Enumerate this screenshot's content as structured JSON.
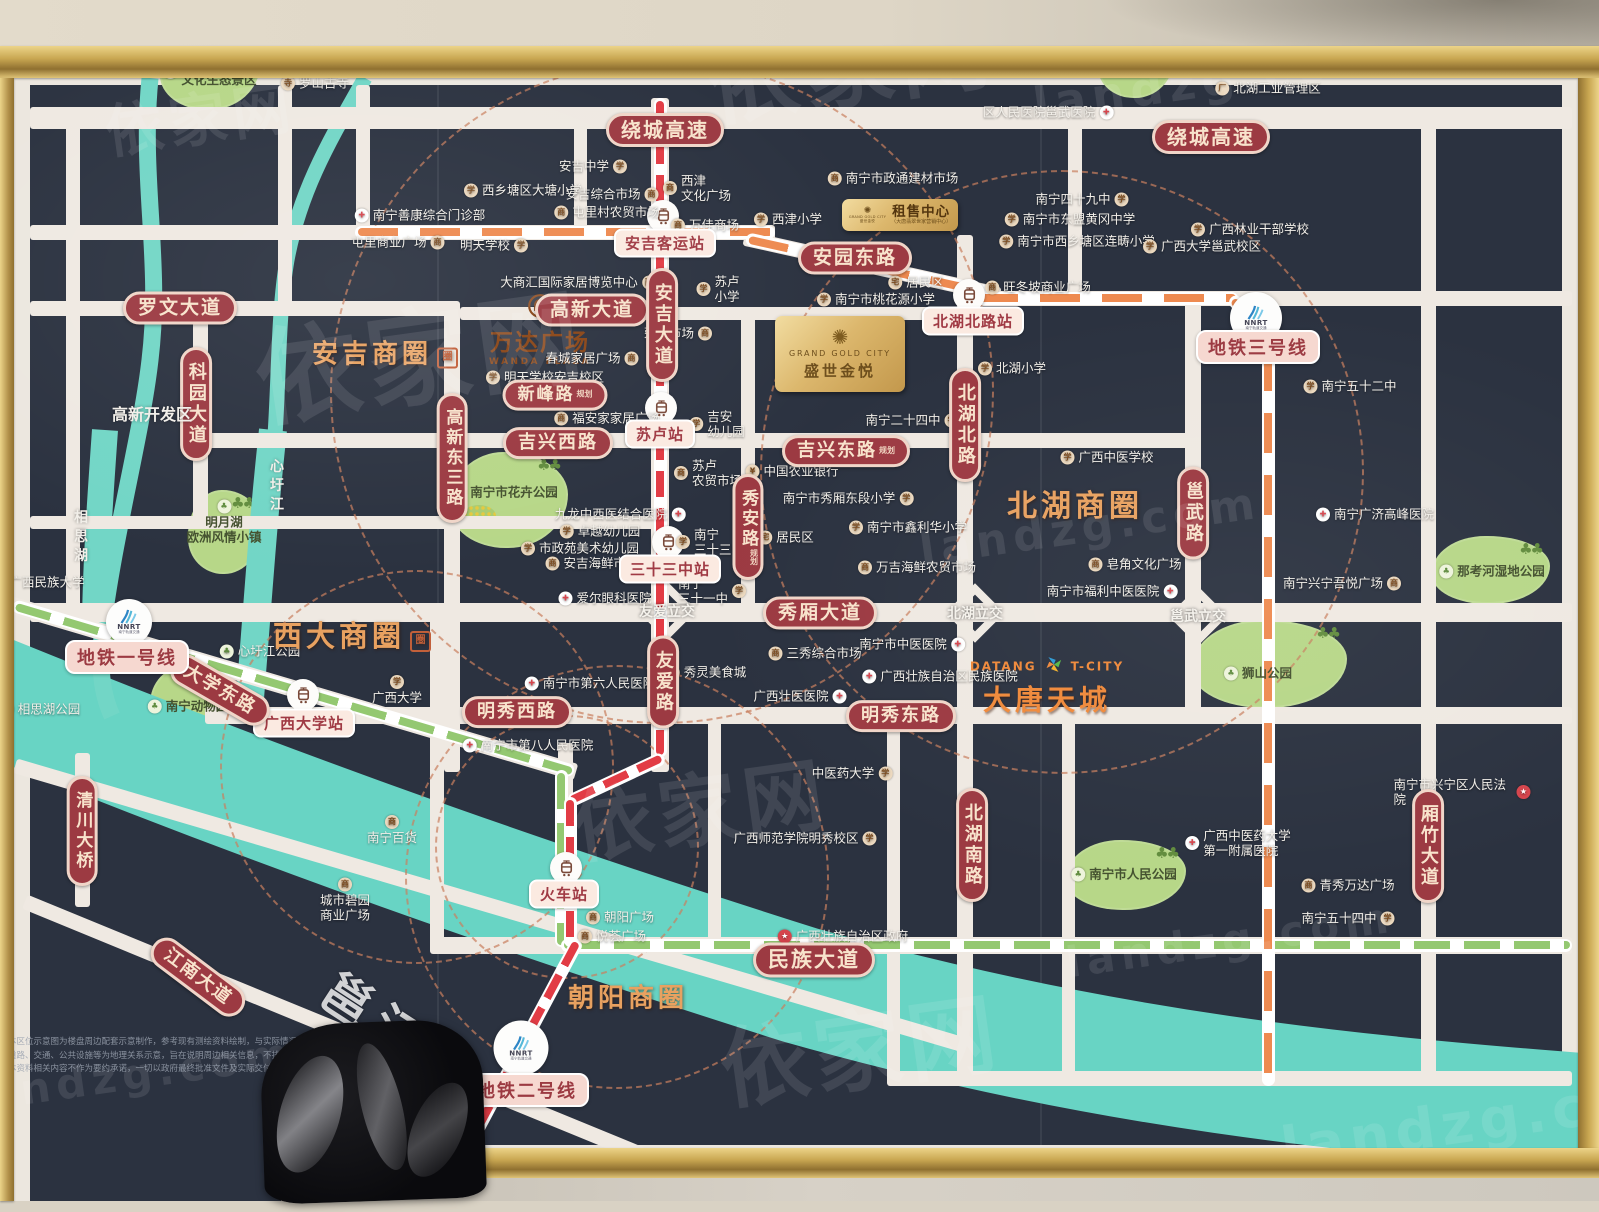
{
  "watermark": {
    "brand": "依家网",
    "url": "landzg.com"
  },
  "plates": {
    "main": {
      "en": "GRAND GOLD CITY",
      "cn": "盛世金悦"
    },
    "rental": {
      "title": "租售中心",
      "sub": "（大唐翡翠世家营销中心）",
      "logo_en": "GRAND GOLD CITY",
      "logo_cn": "盛世金悦"
    }
  },
  "brands": {
    "wanda": {
      "cn": "万达广场",
      "en": "WANDA PLAZA"
    },
    "datang": {
      "left": "DATANG",
      "right": "T-CITY",
      "cn": "大唐天城"
    },
    "nnrt": "NNRT",
    "nnrt_sub": "南宁轨道交通"
  },
  "business_circles": [
    {
      "l": "安吉商圈",
      "x": 385,
      "y": 352,
      "fs": 26,
      "seal": 1
    },
    {
      "l": "西大商圈",
      "x": 352,
      "y": 634,
      "fs": 29,
      "seal": 1
    },
    {
      "l": "北湖商圈",
      "x": 1075,
      "y": 503,
      "fs": 30,
      "seal": 0
    },
    {
      "l": "朝阳商圈",
      "x": 628,
      "y": 996,
      "fs": 26,
      "seal": 0
    }
  ],
  "seal_char": "圈",
  "road_labels": [
    {
      "l": "绕城高速",
      "x": 665,
      "y": 130,
      "fs": 20
    },
    {
      "l": "绕城高速",
      "x": 1211,
      "y": 137,
      "fs": 20
    },
    {
      "l": "罗文大道",
      "x": 180,
      "y": 308,
      "fs": 19
    },
    {
      "l": "科园大道",
      "x": 196,
      "y": 404,
      "fs": 18,
      "v": 1
    },
    {
      "l": "高新大道",
      "x": 592,
      "y": 310,
      "fs": 19
    },
    {
      "l": "安吉大道",
      "x": 662,
      "y": 325,
      "fs": 18,
      "v": 1
    },
    {
      "l": "新峰路",
      "x": 555,
      "y": 395,
      "fs": 17,
      "tag": "规划"
    },
    {
      "l": "高新东三路",
      "x": 452,
      "y": 458,
      "fs": 17,
      "v": 1
    },
    {
      "l": "吉兴西路",
      "x": 558,
      "y": 443,
      "fs": 18
    },
    {
      "l": "吉兴东路",
      "x": 846,
      "y": 451,
      "fs": 18,
      "tag": "规划"
    },
    {
      "l": "安园东路",
      "x": 855,
      "y": 258,
      "fs": 19
    },
    {
      "l": "北湖北路",
      "x": 965,
      "y": 425,
      "fs": 18,
      "v": 1
    },
    {
      "l": "秀安路",
      "x": 748,
      "y": 527,
      "fs": 17,
      "v": 1,
      "tag": "规划"
    },
    {
      "l": "邕武路",
      "x": 1193,
      "y": 513,
      "fs": 18,
      "v": 1
    },
    {
      "l": "秀厢大道",
      "x": 820,
      "y": 613,
      "fs": 19
    },
    {
      "l": "友爱路",
      "x": 663,
      "y": 682,
      "fs": 18,
      "v": 1
    },
    {
      "l": "明秀西路",
      "x": 517,
      "y": 712,
      "fs": 18
    },
    {
      "l": "明秀东路",
      "x": 901,
      "y": 716,
      "fs": 18
    },
    {
      "l": "北湖南路",
      "x": 972,
      "y": 845,
      "fs": 18,
      "v": 1
    },
    {
      "l": "厢竹大道",
      "x": 1428,
      "y": 846,
      "fs": 18,
      "v": 1
    },
    {
      "l": "民族大道",
      "x": 814,
      "y": 960,
      "fs": 21
    },
    {
      "l": "大学东路",
      "x": 220,
      "y": 690,
      "fs": 18,
      "rot": 30
    },
    {
      "l": "江南大道",
      "x": 198,
      "y": 977,
      "fs": 18,
      "rot": 37
    },
    {
      "l": "清川大桥",
      "x": 82,
      "y": 831,
      "fs": 17,
      "v": 1
    }
  ],
  "metro_line_labels": [
    {
      "l": "地铁一号线",
      "x": 127,
      "y": 657
    },
    {
      "l": "地铁二号线",
      "x": 527,
      "y": 1090
    },
    {
      "l": "地铁三号线",
      "x": 1258,
      "y": 347
    }
  ],
  "stations": [
    {
      "l": "安吉客运站",
      "x": 665,
      "y": 243,
      "ix": 663,
      "iy": 216
    },
    {
      "l": "苏卢站",
      "x": 660,
      "y": 434,
      "ix": 661,
      "iy": 408
    },
    {
      "l": "三十三中站",
      "x": 670,
      "y": 569,
      "ix": 668,
      "iy": 542
    },
    {
      "l": "北湖北路站",
      "x": 973,
      "y": 321,
      "ix": 969,
      "iy": 295
    },
    {
      "l": "广西大学站",
      "x": 304,
      "y": 723,
      "ix": 303,
      "iy": 695
    },
    {
      "l": "火车站",
      "x": 564,
      "y": 894,
      "ix": 566,
      "iy": 868
    }
  ],
  "interchanges": [
    {
      "l": "友爱立交",
      "x": 667,
      "y": 611
    },
    {
      "l": "北湖立交",
      "x": 975,
      "y": 613
    },
    {
      "l": "邕武立交",
      "x": 1198,
      "y": 616
    }
  ],
  "area_labels": [
    {
      "l": "高新开发区",
      "x": 152,
      "y": 413,
      "fs": 16
    },
    {
      "l": "心圩江",
      "x": 276,
      "y": 487,
      "fs": 14,
      "v": 1
    },
    {
      "l": "相思湖",
      "x": 80,
      "y": 538,
      "fs": 14,
      "v": 1
    },
    {
      "l": "邕江",
      "x": 378,
      "y": 1016,
      "fs": 50,
      "rot": 33,
      "op": 0.8
    }
  ],
  "pois": [
    {
      "l": "广西龙门水都\n文化生态景区",
      "x": 210,
      "y": 72,
      "ic": "park",
      "gr": 1
    },
    {
      "l": "罗山古寺",
      "x": 315,
      "y": 83,
      "ic": "temple"
    },
    {
      "l": "亚热带植物\n科普园",
      "x": 1137,
      "y": 52,
      "ic": "park",
      "gr": 1
    },
    {
      "l": "区人民医院邕武医院",
      "x": 1048,
      "y": 112,
      "ic": "hospital",
      "sd": "r"
    },
    {
      "l": "北湖工业管理区",
      "x": 1268,
      "y": 88,
      "ic": "factory"
    },
    {
      "l": "南宁市政通建材市场",
      "x": 893,
      "y": 178,
      "ic": "market"
    },
    {
      "l": "安吉中学",
      "x": 593,
      "y": 166,
      "ic": "school",
      "sd": "r"
    },
    {
      "l": "西乡塘区大塘小学",
      "x": 523,
      "y": 190,
      "ic": "school"
    },
    {
      "l": "安吉综合市场",
      "x": 612,
      "y": 194,
      "ic": "market",
      "sd": "r"
    },
    {
      "l": "西津\n文化广场",
      "x": 697,
      "y": 188,
      "ic": "market"
    },
    {
      "l": "南宁四十九中",
      "x": 1082,
      "y": 199,
      "ic": "school",
      "sd": "r"
    },
    {
      "l": "屯里村农贸市场",
      "x": 607,
      "y": 212,
      "ic": "market"
    },
    {
      "l": "万佳商场",
      "x": 705,
      "y": 225,
      "ic": "market"
    },
    {
      "l": "南宁善康综合门诊部",
      "x": 420,
      "y": 215,
      "ic": "hospital"
    },
    {
      "l": "西津小学",
      "x": 788,
      "y": 219,
      "ic": "school"
    },
    {
      "l": "南宁市东盟黄冈中学",
      "x": 1070,
      "y": 219,
      "ic": "school"
    },
    {
      "l": "屯里商业广场",
      "x": 398,
      "y": 242,
      "ic": "market",
      "sd": "r"
    },
    {
      "l": "明天学校",
      "x": 494,
      "y": 245,
      "ic": "school",
      "sd": "r"
    },
    {
      "l": "南宁市西乡塘区连畴小学",
      "x": 1077,
      "y": 241,
      "ic": "school"
    },
    {
      "l": "广西林业干部学校",
      "x": 1250,
      "y": 229,
      "ic": "school"
    },
    {
      "l": "广西大学邕武校区",
      "x": 1202,
      "y": 246,
      "ic": "school"
    },
    {
      "l": "大商汇国际家居博览中心",
      "x": 578,
      "y": 282,
      "ic": "market",
      "sd": "r"
    },
    {
      "l": "旺冬坡商业广场",
      "x": 1038,
      "y": 287,
      "ic": "market"
    },
    {
      "l": "居民区",
      "x": 916,
      "y": 282,
      "ic": "residence"
    },
    {
      "l": "苏卢\n小学",
      "x": 718,
      "y": 289,
      "ic": "school"
    },
    {
      "l": "南宁市桃花源小学",
      "x": 876,
      "y": 299,
      "ic": "school"
    },
    {
      "l": "荣安市场",
      "x": 678,
      "y": 333,
      "ic": "market",
      "sd": "r"
    },
    {
      "l": "北湖小学",
      "x": 1012,
      "y": 368,
      "ic": "school"
    },
    {
      "l": "春城家居广场",
      "x": 592,
      "y": 358,
      "ic": "market",
      "sd": "r"
    },
    {
      "l": "明天学校安吉校区",
      "x": 545,
      "y": 377,
      "ic": "school"
    },
    {
      "l": "福安家家居广场",
      "x": 607,
      "y": 418,
      "ic": "market"
    },
    {
      "l": "吉安\n幼儿园",
      "x": 717,
      "y": 424,
      "ic": "school"
    },
    {
      "l": "南宁二十四中",
      "x": 912,
      "y": 420,
      "ic": "school",
      "sd": "r"
    },
    {
      "l": "苏卢\n农贸市场",
      "x": 708,
      "y": 473,
      "ic": "market"
    },
    {
      "l": "中国农业银行",
      "x": 792,
      "y": 471,
      "ic": "bank"
    },
    {
      "l": "广西中医学校",
      "x": 1107,
      "y": 457,
      "ic": "school"
    },
    {
      "l": "南宁市秀厢东段小学",
      "x": 848,
      "y": 498,
      "ic": "school",
      "sd": "r"
    },
    {
      "l": "九龙中西医结合医院",
      "x": 620,
      "y": 514,
      "ic": "hospital",
      "sd": "r"
    },
    {
      "l": "南宁市鑫利华小学",
      "x": 908,
      "y": 527,
      "ic": "school"
    },
    {
      "l": "卓越幼儿园",
      "x": 600,
      "y": 531,
      "ic": "school"
    },
    {
      "l": "居民区",
      "x": 786,
      "y": 537,
      "ic": "residence"
    },
    {
      "l": "市政苑美术幼儿园",
      "x": 580,
      "y": 548,
      "ic": "school"
    },
    {
      "l": "南宁\n三十三中",
      "x": 710,
      "y": 542,
      "ic": "school"
    },
    {
      "l": "安吉海鲜市场",
      "x": 592,
      "y": 563,
      "ic": "market"
    },
    {
      "l": "万吉海鲜农贸市场",
      "x": 917,
      "y": 567,
      "ic": "market"
    },
    {
      "l": "皂角文化广场",
      "x": 1135,
      "y": 564,
      "ic": "market"
    },
    {
      "l": "南宁\n三十一中",
      "x": 712,
      "y": 591,
      "ic": "school",
      "sd": "r"
    },
    {
      "l": "爱尔眼科医院",
      "x": 605,
      "y": 598,
      "ic": "hospital"
    },
    {
      "l": "南宁市福利中医医院",
      "x": 1112,
      "y": 591,
      "ic": "hospital",
      "sd": "r"
    },
    {
      "l": "南宁五十二中",
      "x": 1350,
      "y": 386,
      "ic": "school"
    },
    {
      "l": "南宁广济高峰医院",
      "x": 1375,
      "y": 514,
      "ic": "hospital"
    },
    {
      "l": "南宁市中医医院",
      "x": 912,
      "y": 644,
      "ic": "hospital",
      "sd": "r"
    },
    {
      "l": "三秀综合市场",
      "x": 815,
      "y": 653,
      "ic": "market"
    },
    {
      "l": "秀灵美食城",
      "x": 706,
      "y": 672,
      "ic": "market"
    },
    {
      "l": "广西壮族自治区民族医院",
      "x": 940,
      "y": 676,
      "ic": "hospital"
    },
    {
      "l": "广西壮医医院",
      "x": 800,
      "y": 696,
      "ic": "hospital",
      "sd": "r"
    },
    {
      "l": "南宁市第六人民医院",
      "x": 590,
      "y": 683,
      "ic": "hospital"
    },
    {
      "l": "广西大学",
      "x": 397,
      "y": 690,
      "ic": "school",
      "sd": "t"
    },
    {
      "l": "南宁市第八人民医院",
      "x": 528,
      "y": 745,
      "ic": "hospital"
    },
    {
      "l": "广西民族大学",
      "x": 38,
      "y": 582,
      "ic": "school"
    },
    {
      "l": "中医药大学",
      "x": 852,
      "y": 773,
      "ic": "school",
      "sd": "r"
    },
    {
      "l": "南宁兴宁吾悦广场",
      "x": 1342,
      "y": 583,
      "ic": "market",
      "sd": "r"
    },
    {
      "l": "广西师范学院明秀校区",
      "x": 805,
      "y": 838,
      "ic": "school",
      "sd": "r"
    },
    {
      "l": "南宁百货",
      "x": 392,
      "y": 830,
      "ic": "market",
      "sd": "t"
    },
    {
      "l": "城市碧园\n商业广场",
      "x": 345,
      "y": 900,
      "ic": "market",
      "sd": "t"
    },
    {
      "l": "朝阳广场",
      "x": 620,
      "y": 917,
      "ic": "market"
    },
    {
      "l": "悦荟广场",
      "x": 612,
      "y": 936,
      "ic": "market"
    },
    {
      "l": "广西壮族自治区政府",
      "x": 843,
      "y": 936,
      "ic": "gov"
    },
    {
      "l": "广西中医药大学\n第一附属医院",
      "x": 1238,
      "y": 843,
      "ic": "hospital"
    },
    {
      "l": "青秀万达广场",
      "x": 1348,
      "y": 885,
      "ic": "market"
    },
    {
      "l": "南宁五十四中",
      "x": 1348,
      "y": 918,
      "ic": "school",
      "sd": "r"
    },
    {
      "l": "南宁市兴宁区人民法院",
      "x": 1462,
      "y": 792,
      "ic": "gov",
      "sd": "r"
    },
    {
      "l": "心圩江公园",
      "x": 260,
      "y": 651,
      "ic": "park"
    },
    {
      "l": "相思湖公园",
      "x": 40,
      "y": 709,
      "ic": "park"
    },
    {
      "l": "那考河湿地公园",
      "x": 1492,
      "y": 571,
      "ic": "park",
      "gr": 1
    },
    {
      "l": "狮山公园",
      "x": 1258,
      "y": 673,
      "ic": "park",
      "gr": 1
    },
    {
      "l": "南宁市人民公园",
      "x": 1124,
      "y": 874,
      "ic": "park",
      "gr": 1
    },
    {
      "l": "南宁市花卉公园",
      "x": 505,
      "y": 492,
      "ic": "park",
      "gr": 1
    },
    {
      "l": "南宁动物园",
      "x": 188,
      "y": 706,
      "ic": "park",
      "gr": 1
    },
    {
      "l": "明月湖\n欧洲风情小镇",
      "x": 224,
      "y": 522,
      "ic": "park",
      "sd": "t",
      "gr": 1
    }
  ],
  "disclaimer": [
    "本区位示意图为楼盘周边配套示意制作，参考现有测绘资料绘制，与实际情况可能存在一定差异。",
    "道路、交通、公共设施等为地理关系示意，旨在说明周边相关信息，不排除因政府规划调整而发生变化。",
    "本资料相关内容不作为要约承诺，一切以政府最终批准文件及实际交付为准，不再另行通知。"
  ]
}
